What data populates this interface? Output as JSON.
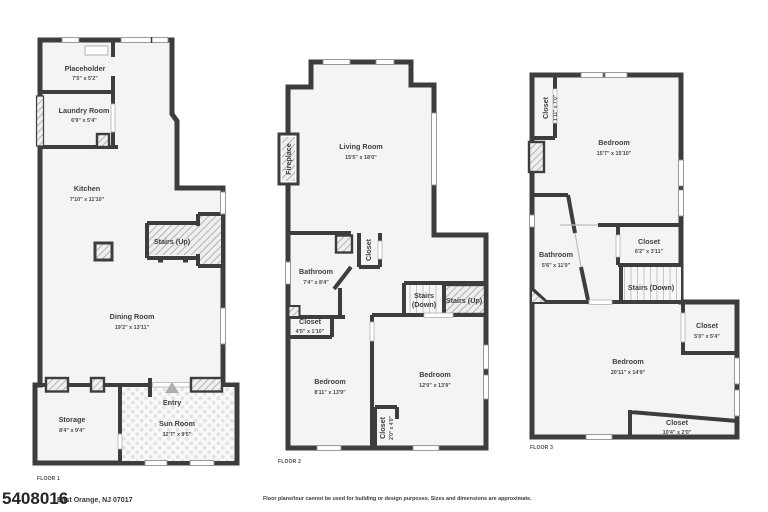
{
  "colors": {
    "wall": "#3d3d3d",
    "room_fill": "#f4f4f4",
    "text": "#3f3f3f"
  },
  "floors": [
    {
      "label": "FLOOR 1",
      "rooms": {
        "placeholder": {
          "name": "Placeholder",
          "dims": "7'5\" x 5'2\""
        },
        "laundry": {
          "name": "Laundry Room",
          "dims": "6'9\" x 5'4\""
        },
        "kitchen": {
          "name": "Kitchen",
          "dims": "7'10\" x 11'10\""
        },
        "stairs_up": {
          "name": "Stairs (Up)"
        },
        "dining": {
          "name": "Dining Room",
          "dims": "19'2\" x 13'11\""
        },
        "storage": {
          "name": "Storage",
          "dims": "8'4\" x 9'4\""
        },
        "entry": {
          "name": "Entry"
        },
        "sunroom": {
          "name": "Sun Room",
          "dims": "12'7\" x 9'5\""
        }
      }
    },
    {
      "label": "FLOOR 2",
      "rooms": {
        "living": {
          "name": "Living Room",
          "dims": "15'5\" x 18'0\""
        },
        "fireplace": {
          "name": "Fireplace"
        },
        "bathroom": {
          "name": "Bathroom",
          "dims": "7'4\" x 8'4\""
        },
        "closet_hall": {
          "name": "Closet"
        },
        "closet_small": {
          "name": "Closet",
          "dims": "4'5\" x 1'10\""
        },
        "stairs_down": {
          "name": "Stairs",
          "dims": "(Down)"
        },
        "stairs_up": {
          "name": "Stairs (Up)"
        },
        "bedroom_left": {
          "name": "Bedroom",
          "dims": "8'11\" x 13'9\""
        },
        "bedroom_right": {
          "name": "Bedroom",
          "dims": "12'0\" x 13'9\""
        },
        "closet_bottom": {
          "name": "Closet",
          "dims": "2'0\" x 4'0\""
        }
      }
    },
    {
      "label": "FLOOR 3",
      "rooms": {
        "closet_top": {
          "name": "Closet",
          "dims": "1'11\" x 7'0\""
        },
        "bedroom_top": {
          "name": "Bedroom",
          "dims": "15'7\" x 15'10\""
        },
        "bathroom": {
          "name": "Bathroom",
          "dims": "5'6\" x 11'0\""
        },
        "closet_mid": {
          "name": "Closet",
          "dims": "6'2\" x 3'11\""
        },
        "stairs_down": {
          "name": "Stairs (Down)"
        },
        "closet_right": {
          "name": "Closet",
          "dims": "5'0\" x 5'4\""
        },
        "bedroom_bottom": {
          "name": "Bedroom",
          "dims": "20'11\" x 14'9\""
        },
        "closet_bottom": {
          "name": "Closet",
          "dims": "10'4\" x 2'0\""
        }
      }
    }
  ],
  "footer": {
    "watermark": "5408016",
    "address": "East Orange, NJ 07017",
    "disclaimer": "Floor plans/tour cannot be used for building or design purposes. Sizes and dimensions are approximate."
  }
}
